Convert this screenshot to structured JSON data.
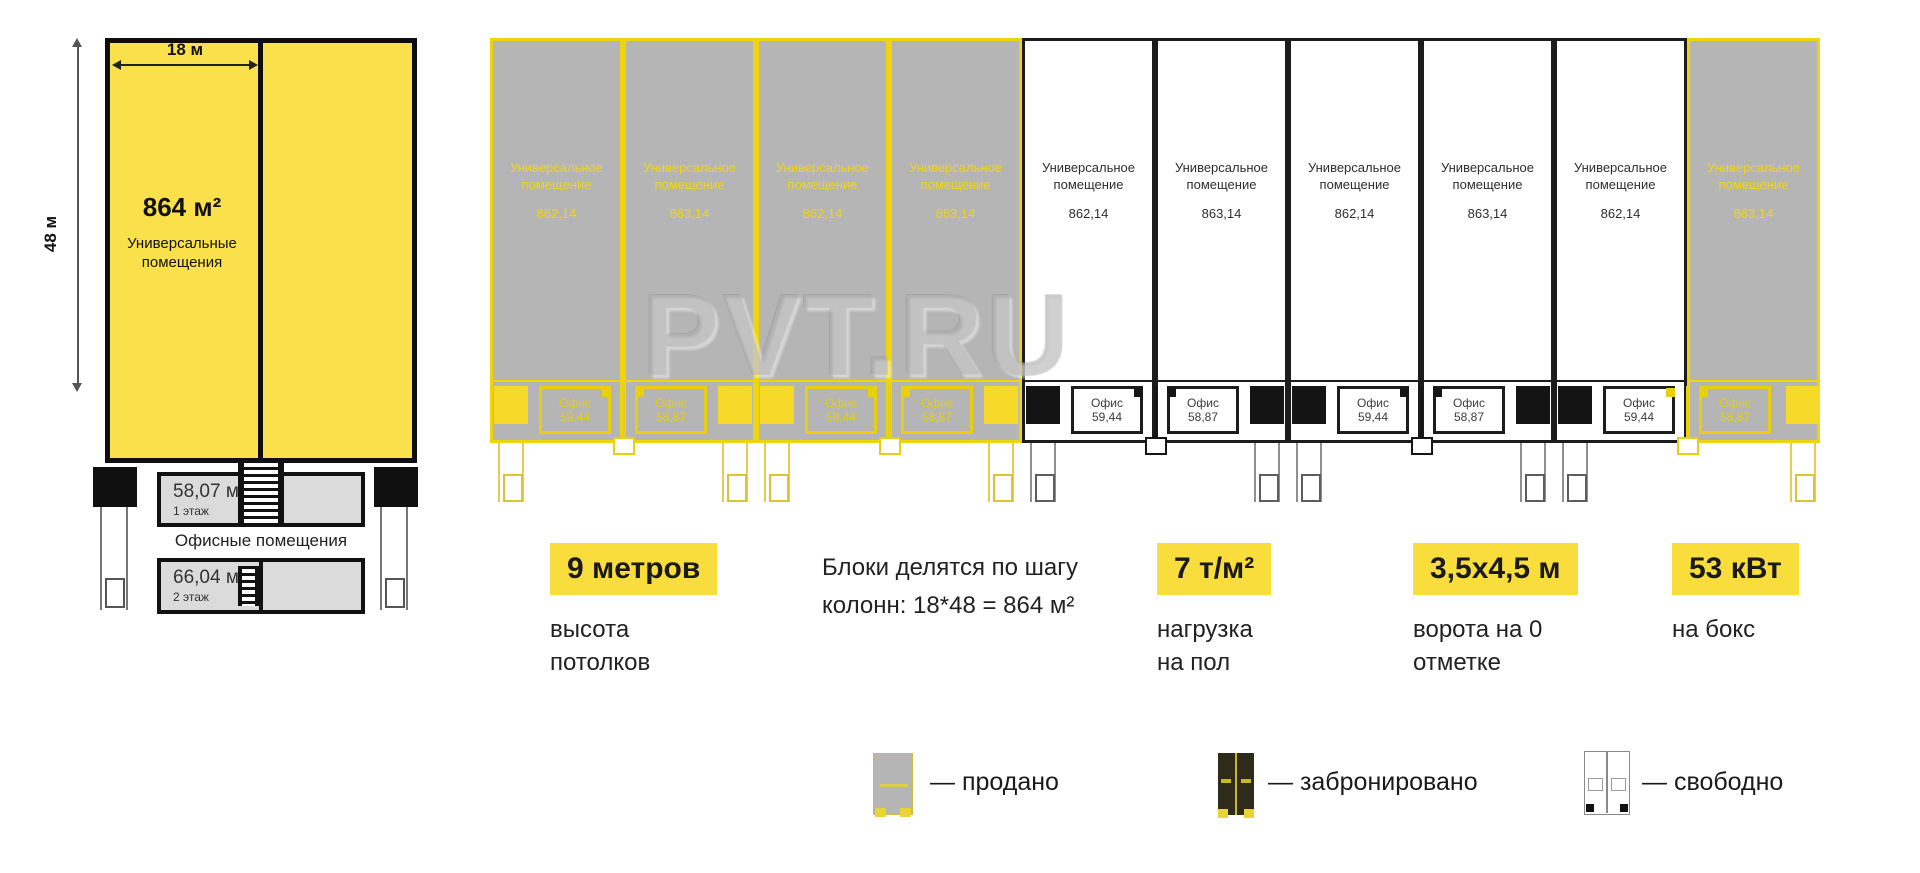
{
  "left_plan": {
    "width_label": "18 м",
    "height_label": "48 м",
    "area": "864 м²",
    "hall_name": "Универсальные помещения",
    "office_floor1": {
      "area": "58,07 м²",
      "floor": "1 этаж"
    },
    "offices_caption": "Офисные помещения",
    "office_floor2": {
      "area": "66,04 м²",
      "floor": "2 этаж"
    }
  },
  "units_row": {
    "unit_name_line1": "Универсальное",
    "unit_name_line2": "помещение",
    "office_label": "Офис",
    "units": [
      {
        "area": "862,14",
        "office_area": "59,44",
        "status": "sold"
      },
      {
        "area": "863,14",
        "office_area": "58,87",
        "status": "sold"
      },
      {
        "area": "862,14",
        "office_area": "59,44",
        "status": "sold"
      },
      {
        "area": "863,14",
        "office_area": "58,87",
        "status": "sold"
      },
      {
        "area": "862,14",
        "office_area": "59,44",
        "status": "free"
      },
      {
        "area": "863,14",
        "office_area": "58,87",
        "status": "free"
      },
      {
        "area": "862,14",
        "office_area": "59,44",
        "status": "free"
      },
      {
        "area": "863,14",
        "office_area": "58,87",
        "status": "free"
      },
      {
        "area": "862,14",
        "office_area": "59,44",
        "status": "free"
      },
      {
        "area": "863,14",
        "office_area": "58,87",
        "status": "sold"
      }
    ]
  },
  "watermark": "PVT.RU",
  "note_line1": "Блоки делятся по шагу",
  "note_line2": "колонн: 18*48 = 864 м²",
  "specs": [
    {
      "value": "9 метров",
      "label": "высота потолков"
    },
    {
      "value": "7 т/м²",
      "label": "нагрузка на пол"
    },
    {
      "value": "3,5х4,5 м",
      "label": "ворота на 0 отметке"
    },
    {
      "value": "53 кВт",
      "label": "на бокс"
    }
  ],
  "legend": [
    {
      "label": "— продано",
      "status": "sold"
    },
    {
      "label": "— забронировано",
      "status": "booked"
    },
    {
      "label": "— свободно",
      "status": "free"
    }
  ],
  "colors": {
    "accent_yellow": "#F8DD3C",
    "plan_yellow": "#FAE14C",
    "sold_outline": "#EFD40C",
    "sold_fill": "#B5B5B5",
    "free_outline": "#1C1C1C",
    "booked_fill": "#2E2B1A"
  }
}
